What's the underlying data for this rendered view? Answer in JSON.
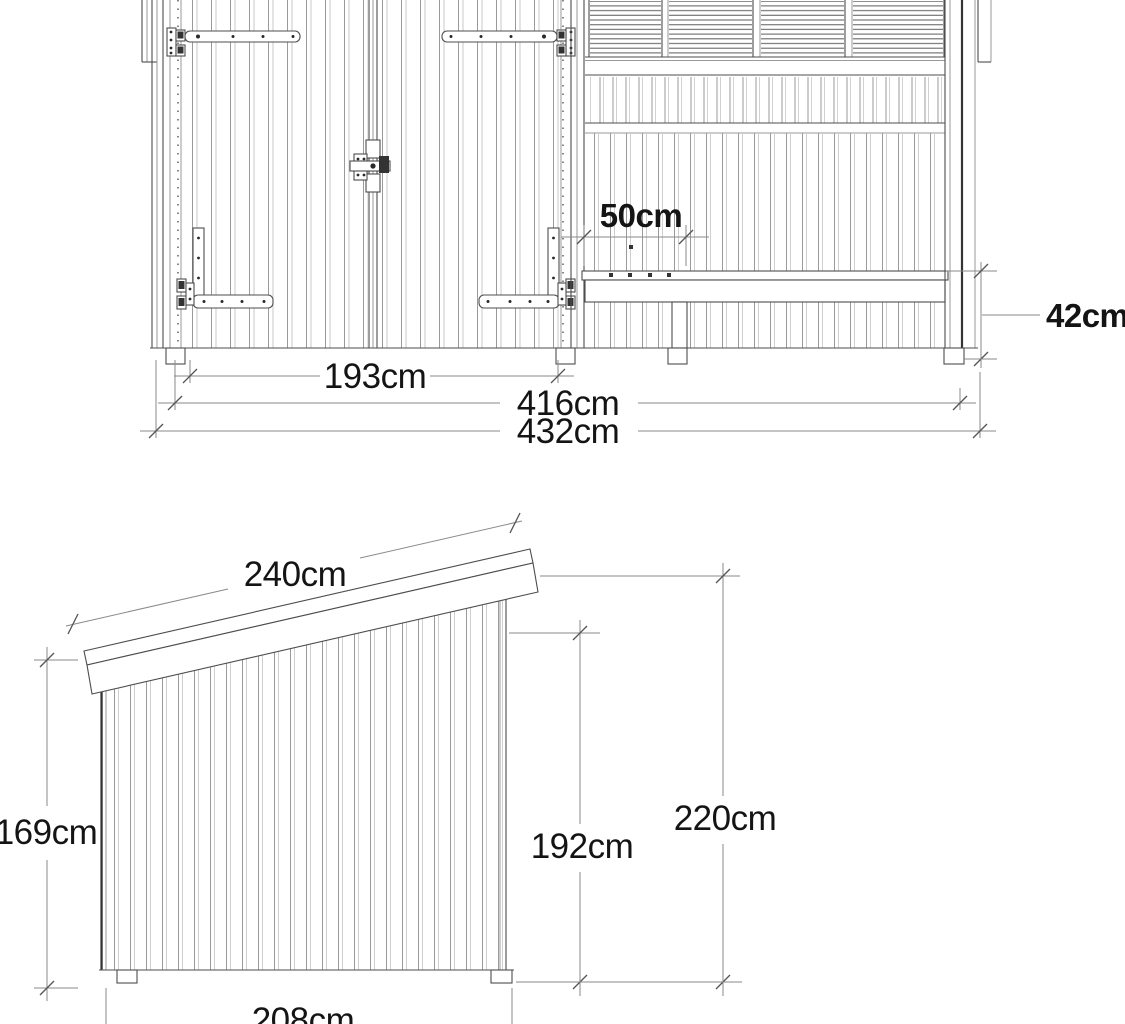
{
  "front_view": {
    "dimensions": {
      "door_section_width": "193cm",
      "opening_width": "416cm",
      "total_width": "432cm",
      "bench_depth": "50cm",
      "bench_height": "42cm"
    }
  },
  "side_view": {
    "dimensions": {
      "roof_length": "240cm",
      "front_height": "169cm",
      "wall_height": "192cm",
      "total_height": "220cm",
      "depth": "208cm"
    }
  },
  "style": {
    "background": "#ffffff",
    "line_color": "#4d4d4d",
    "dim_line_color": "#8a8a8a",
    "text_color": "#141414"
  }
}
